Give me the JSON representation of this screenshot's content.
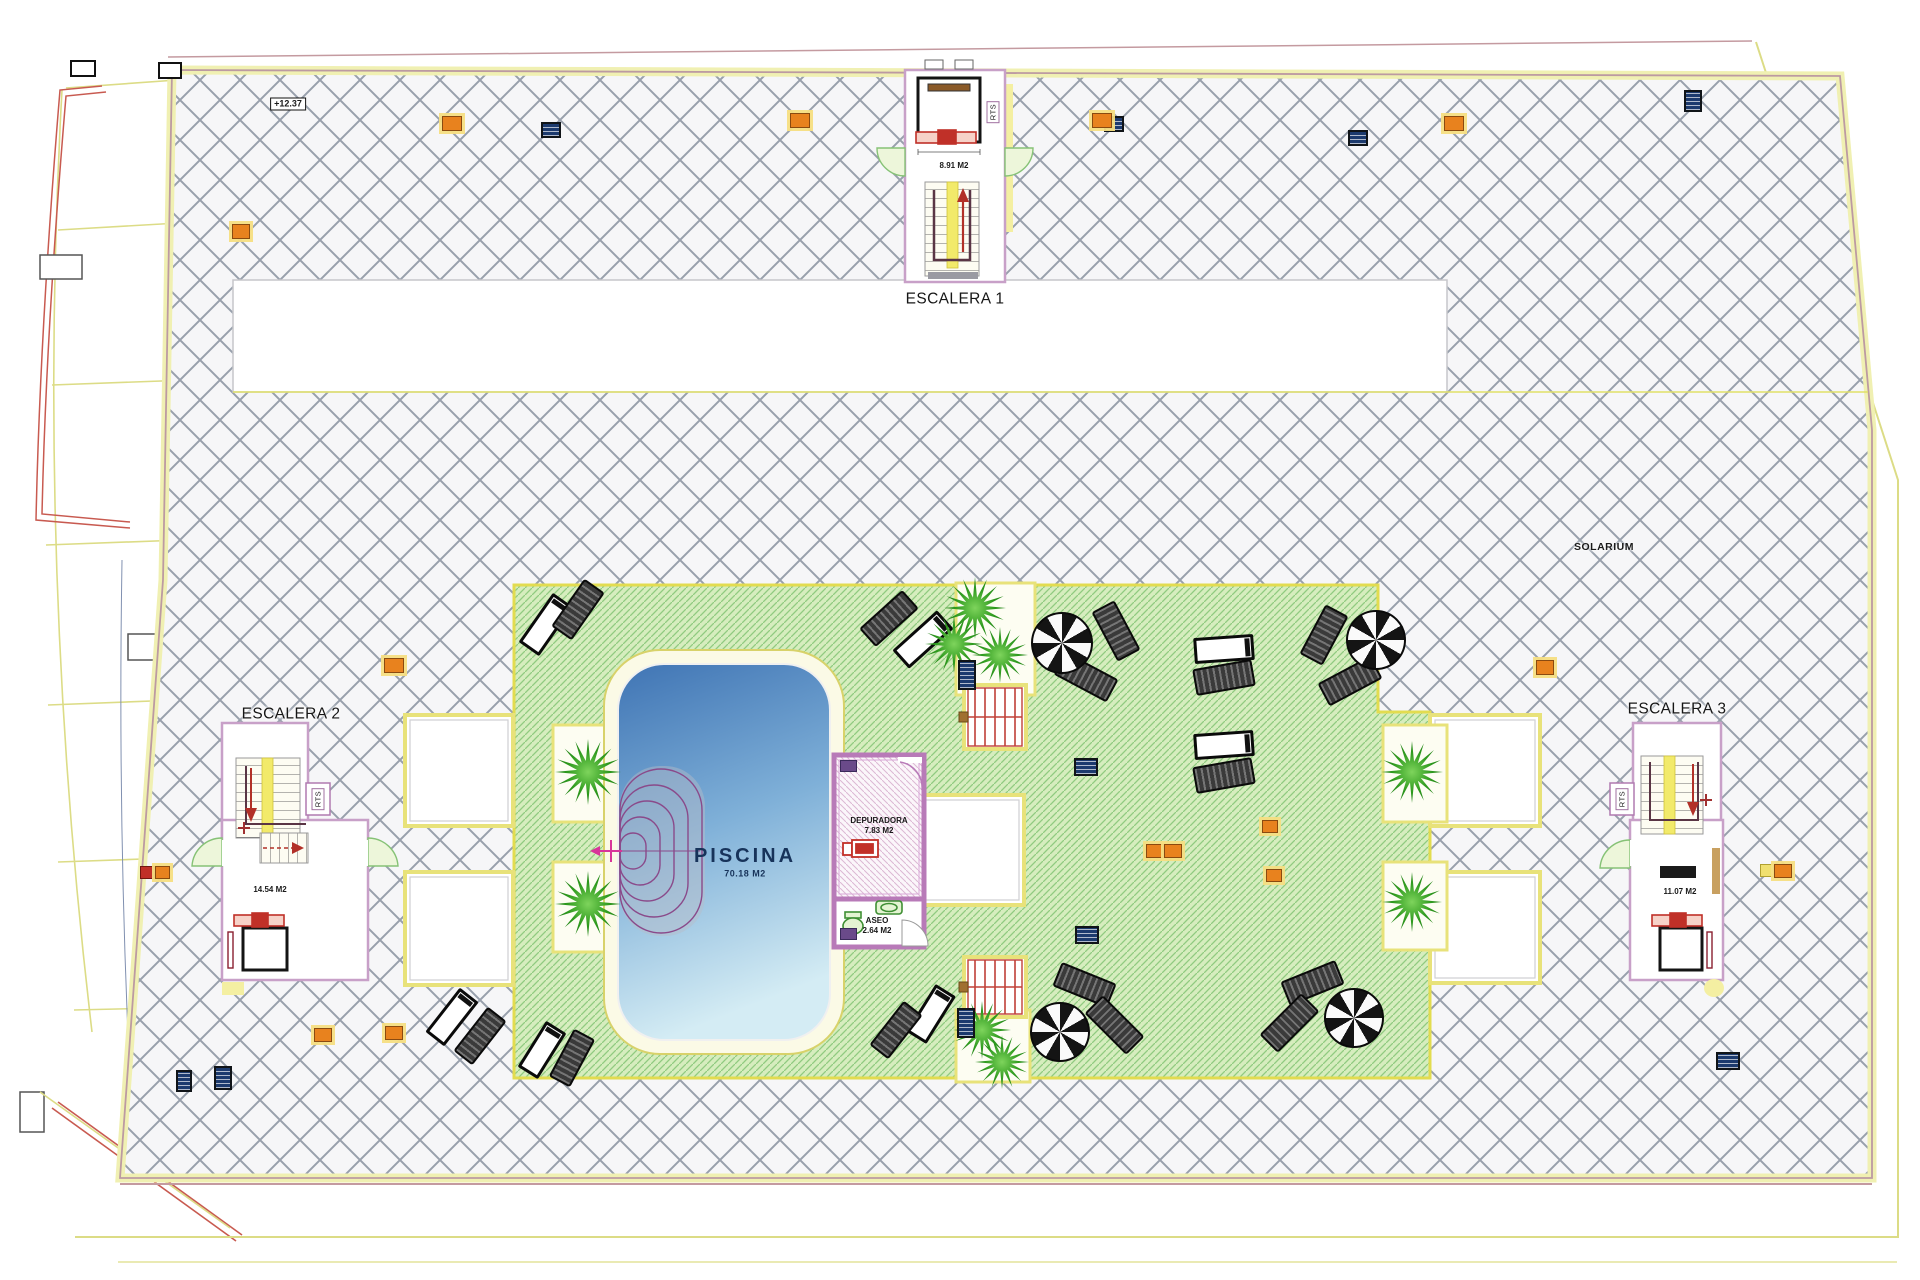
{
  "labels": {
    "escalera1": "ESCALERA 1",
    "escalera2": "ESCALERA 2",
    "escalera3": "ESCALERA 3",
    "solarium": "SOLARIUM",
    "piscina": "PISCINA",
    "piscina_area": "70.18 M2",
    "depuradora": "DEPURADORA",
    "depuradora_area": "7.83 M2",
    "aseo": "ASEO",
    "aseo_area": "2.64 M2",
    "esc1_area": "8.91 M2",
    "esc2_area": "14.54 M2",
    "esc3_area": "11.07 M2",
    "rts": "RTS",
    "elevation": "+12.37"
  },
  "colors": {
    "hatch_line": "#98a0ac",
    "terrace_bg": "#f6f6f8",
    "deck_green": "#d6edbe",
    "deck_line": "#90cb80",
    "deck_border_yellow": "#e2dc50",
    "pool_deep": "#3f74b4",
    "pool_shallow": "#d4ecf4",
    "wall_pink": "#c8a0c8",
    "stair_yellow": "#f2ea6a",
    "red_accent": "#c03028",
    "orange_marker": "#e8821e",
    "blue_marker": "#1c3a6e"
  },
  "furniture": [
    {
      "t": "umb",
      "x": 1060,
      "y": 641,
      "d": 58
    },
    {
      "t": "umb",
      "x": 1374,
      "y": 638,
      "d": 56
    },
    {
      "t": "umb",
      "x": 1058,
      "y": 1030,
      "d": 56
    },
    {
      "t": "umb",
      "x": 1352,
      "y": 1016,
      "d": 56
    },
    {
      "t": "ld",
      "x": 1088,
      "y": 618,
      "w": 52,
      "h": 22,
      "r": 62
    },
    {
      "t": "ld",
      "x": 1056,
      "y": 664,
      "w": 56,
      "h": 22,
      "r": 28
    },
    {
      "t": "ld",
      "x": 1296,
      "y": 622,
      "w": 52,
      "h": 22,
      "r": -62
    },
    {
      "t": "ld",
      "x": 1320,
      "y": 668,
      "w": 56,
      "h": 22,
      "r": -28
    },
    {
      "t": "ld",
      "x": 1055,
      "y": 972,
      "w": 55,
      "h": 22,
      "r": 22
    },
    {
      "t": "ld",
      "x": 1085,
      "y": 1012,
      "w": 55,
      "h": 22,
      "r": 45
    },
    {
      "t": "ld",
      "x": 1283,
      "y": 970,
      "w": 55,
      "h": 22,
      "r": -22
    },
    {
      "t": "ld",
      "x": 1260,
      "y": 1010,
      "w": 55,
      "h": 22,
      "r": -45
    },
    {
      "t": "lw",
      "x": 516,
      "y": 612,
      "w": 54,
      "h": 19,
      "r": -55
    },
    {
      "t": "ld",
      "x": 549,
      "y": 597,
      "w": 54,
      "h": 21,
      "r": -55
    },
    {
      "t": "ld",
      "x": 860,
      "y": 606,
      "w": 54,
      "h": 21,
      "r": -42
    },
    {
      "t": "lw",
      "x": 893,
      "y": 627,
      "w": 54,
      "h": 19,
      "r": -42
    },
    {
      "t": "lw",
      "x": 1194,
      "y": 636,
      "w": 54,
      "h": 20,
      "r": -4
    },
    {
      "t": "ld",
      "x": 1194,
      "y": 664,
      "w": 56,
      "h": 23,
      "r": -10
    },
    {
      "t": "lw",
      "x": 1194,
      "y": 732,
      "w": 54,
      "h": 20,
      "r": -4
    },
    {
      "t": "ld",
      "x": 1194,
      "y": 762,
      "w": 56,
      "h": 23,
      "r": -10
    },
    {
      "t": "lw",
      "x": 424,
      "y": 1005,
      "w": 50,
      "h": 18,
      "r": -52
    },
    {
      "t": "ld",
      "x": 452,
      "y": 1024,
      "w": 52,
      "h": 20,
      "r": -52
    },
    {
      "t": "lw",
      "x": 515,
      "y": 1038,
      "w": 48,
      "h": 18,
      "r": -58
    },
    {
      "t": "ld",
      "x": 545,
      "y": 1046,
      "w": 50,
      "h": 20,
      "r": -62
    },
    {
      "t": "lw",
      "x": 903,
      "y": 1002,
      "w": 50,
      "h": 18,
      "r": -58
    },
    {
      "t": "ld",
      "x": 868,
      "y": 1018,
      "w": 52,
      "h": 20,
      "r": -52
    }
  ],
  "palms": [
    {
      "x": 975,
      "y": 608,
      "s": 62
    },
    {
      "x": 954,
      "y": 644,
      "s": 58
    },
    {
      "x": 1000,
      "y": 655,
      "s": 56
    },
    {
      "x": 588,
      "y": 772,
      "s": 66
    },
    {
      "x": 588,
      "y": 904,
      "s": 66
    },
    {
      "x": 1412,
      "y": 772,
      "s": 62
    },
    {
      "x": 1412,
      "y": 902,
      "s": 60
    },
    {
      "x": 982,
      "y": 1030,
      "s": 58
    },
    {
      "x": 1002,
      "y": 1062,
      "s": 54
    }
  ],
  "markers": [
    {
      "c": "blue",
      "x": 541,
      "y": 122,
      "w": 16,
      "h": 12
    },
    {
      "c": "blue",
      "x": 1104,
      "y": 116,
      "w": 16,
      "h": 12
    },
    {
      "c": "blue",
      "x": 1348,
      "y": 130,
      "w": 16,
      "h": 12
    },
    {
      "c": "blue",
      "x": 1684,
      "y": 90,
      "w": 14,
      "h": 18
    },
    {
      "c": "blue",
      "x": 214,
      "y": 1066,
      "w": 14,
      "h": 20
    },
    {
      "c": "blue",
      "x": 176,
      "y": 1070,
      "w": 12,
      "h": 18
    },
    {
      "c": "blue",
      "x": 958,
      "y": 660,
      "w": 14,
      "h": 26
    },
    {
      "c": "blue",
      "x": 1074,
      "y": 758,
      "w": 20,
      "h": 14
    },
    {
      "c": "blue",
      "x": 1075,
      "y": 926,
      "w": 20,
      "h": 14
    },
    {
      "c": "blue",
      "x": 957,
      "y": 1008,
      "w": 14,
      "h": 26
    },
    {
      "c": "blue",
      "x": 1716,
      "y": 1052,
      "w": 20,
      "h": 14
    },
    {
      "c": "orange",
      "x": 442,
      "y": 116,
      "w": 18,
      "h": 13
    },
    {
      "c": "orange",
      "x": 790,
      "y": 113,
      "w": 18,
      "h": 13
    },
    {
      "c": "orange",
      "x": 1092,
      "y": 113,
      "w": 18,
      "h": 13
    },
    {
      "c": "orange",
      "x": 1444,
      "y": 116,
      "w": 18,
      "h": 13
    },
    {
      "c": "orange",
      "x": 232,
      "y": 224,
      "w": 16,
      "h": 13
    },
    {
      "c": "orange",
      "x": 384,
      "y": 658,
      "w": 18,
      "h": 13
    },
    {
      "c": "orange",
      "x": 1536,
      "y": 660,
      "w": 16,
      "h": 13
    },
    {
      "c": "orange",
      "x": 1262,
      "y": 820,
      "w": 14,
      "h": 11
    },
    {
      "c": "orange",
      "x": 1146,
      "y": 844,
      "w": 16,
      "h": 12
    },
    {
      "c": "orange",
      "x": 1164,
      "y": 844,
      "w": 16,
      "h": 12
    },
    {
      "c": "orange",
      "x": 1266,
      "y": 869,
      "w": 14,
      "h": 11
    },
    {
      "c": "orange",
      "x": 314,
      "y": 1028,
      "w": 16,
      "h": 12
    },
    {
      "c": "orange",
      "x": 385,
      "y": 1026,
      "w": 16,
      "h": 12
    },
    {
      "c": "red",
      "x": 140,
      "y": 866,
      "w": 13,
      "h": 11
    },
    {
      "c": "orange",
      "x": 155,
      "y": 866,
      "w": 13,
      "h": 11
    },
    {
      "c": "yellow",
      "x": 1760,
      "y": 864,
      "w": 12,
      "h": 11
    },
    {
      "c": "orange",
      "x": 1774,
      "y": 864,
      "w": 16,
      "h": 12
    },
    {
      "c": "purple",
      "x": 840,
      "y": 760,
      "w": 15,
      "h": 10
    },
    {
      "c": "purple",
      "x": 840,
      "y": 928,
      "w": 15,
      "h": 10
    },
    {
      "c": "cbox",
      "x": 158,
      "y": 62,
      "w": 20,
      "h": 13
    },
    {
      "c": "cbox",
      "x": 70,
      "y": 60,
      "w": 22,
      "h": 13
    }
  ]
}
